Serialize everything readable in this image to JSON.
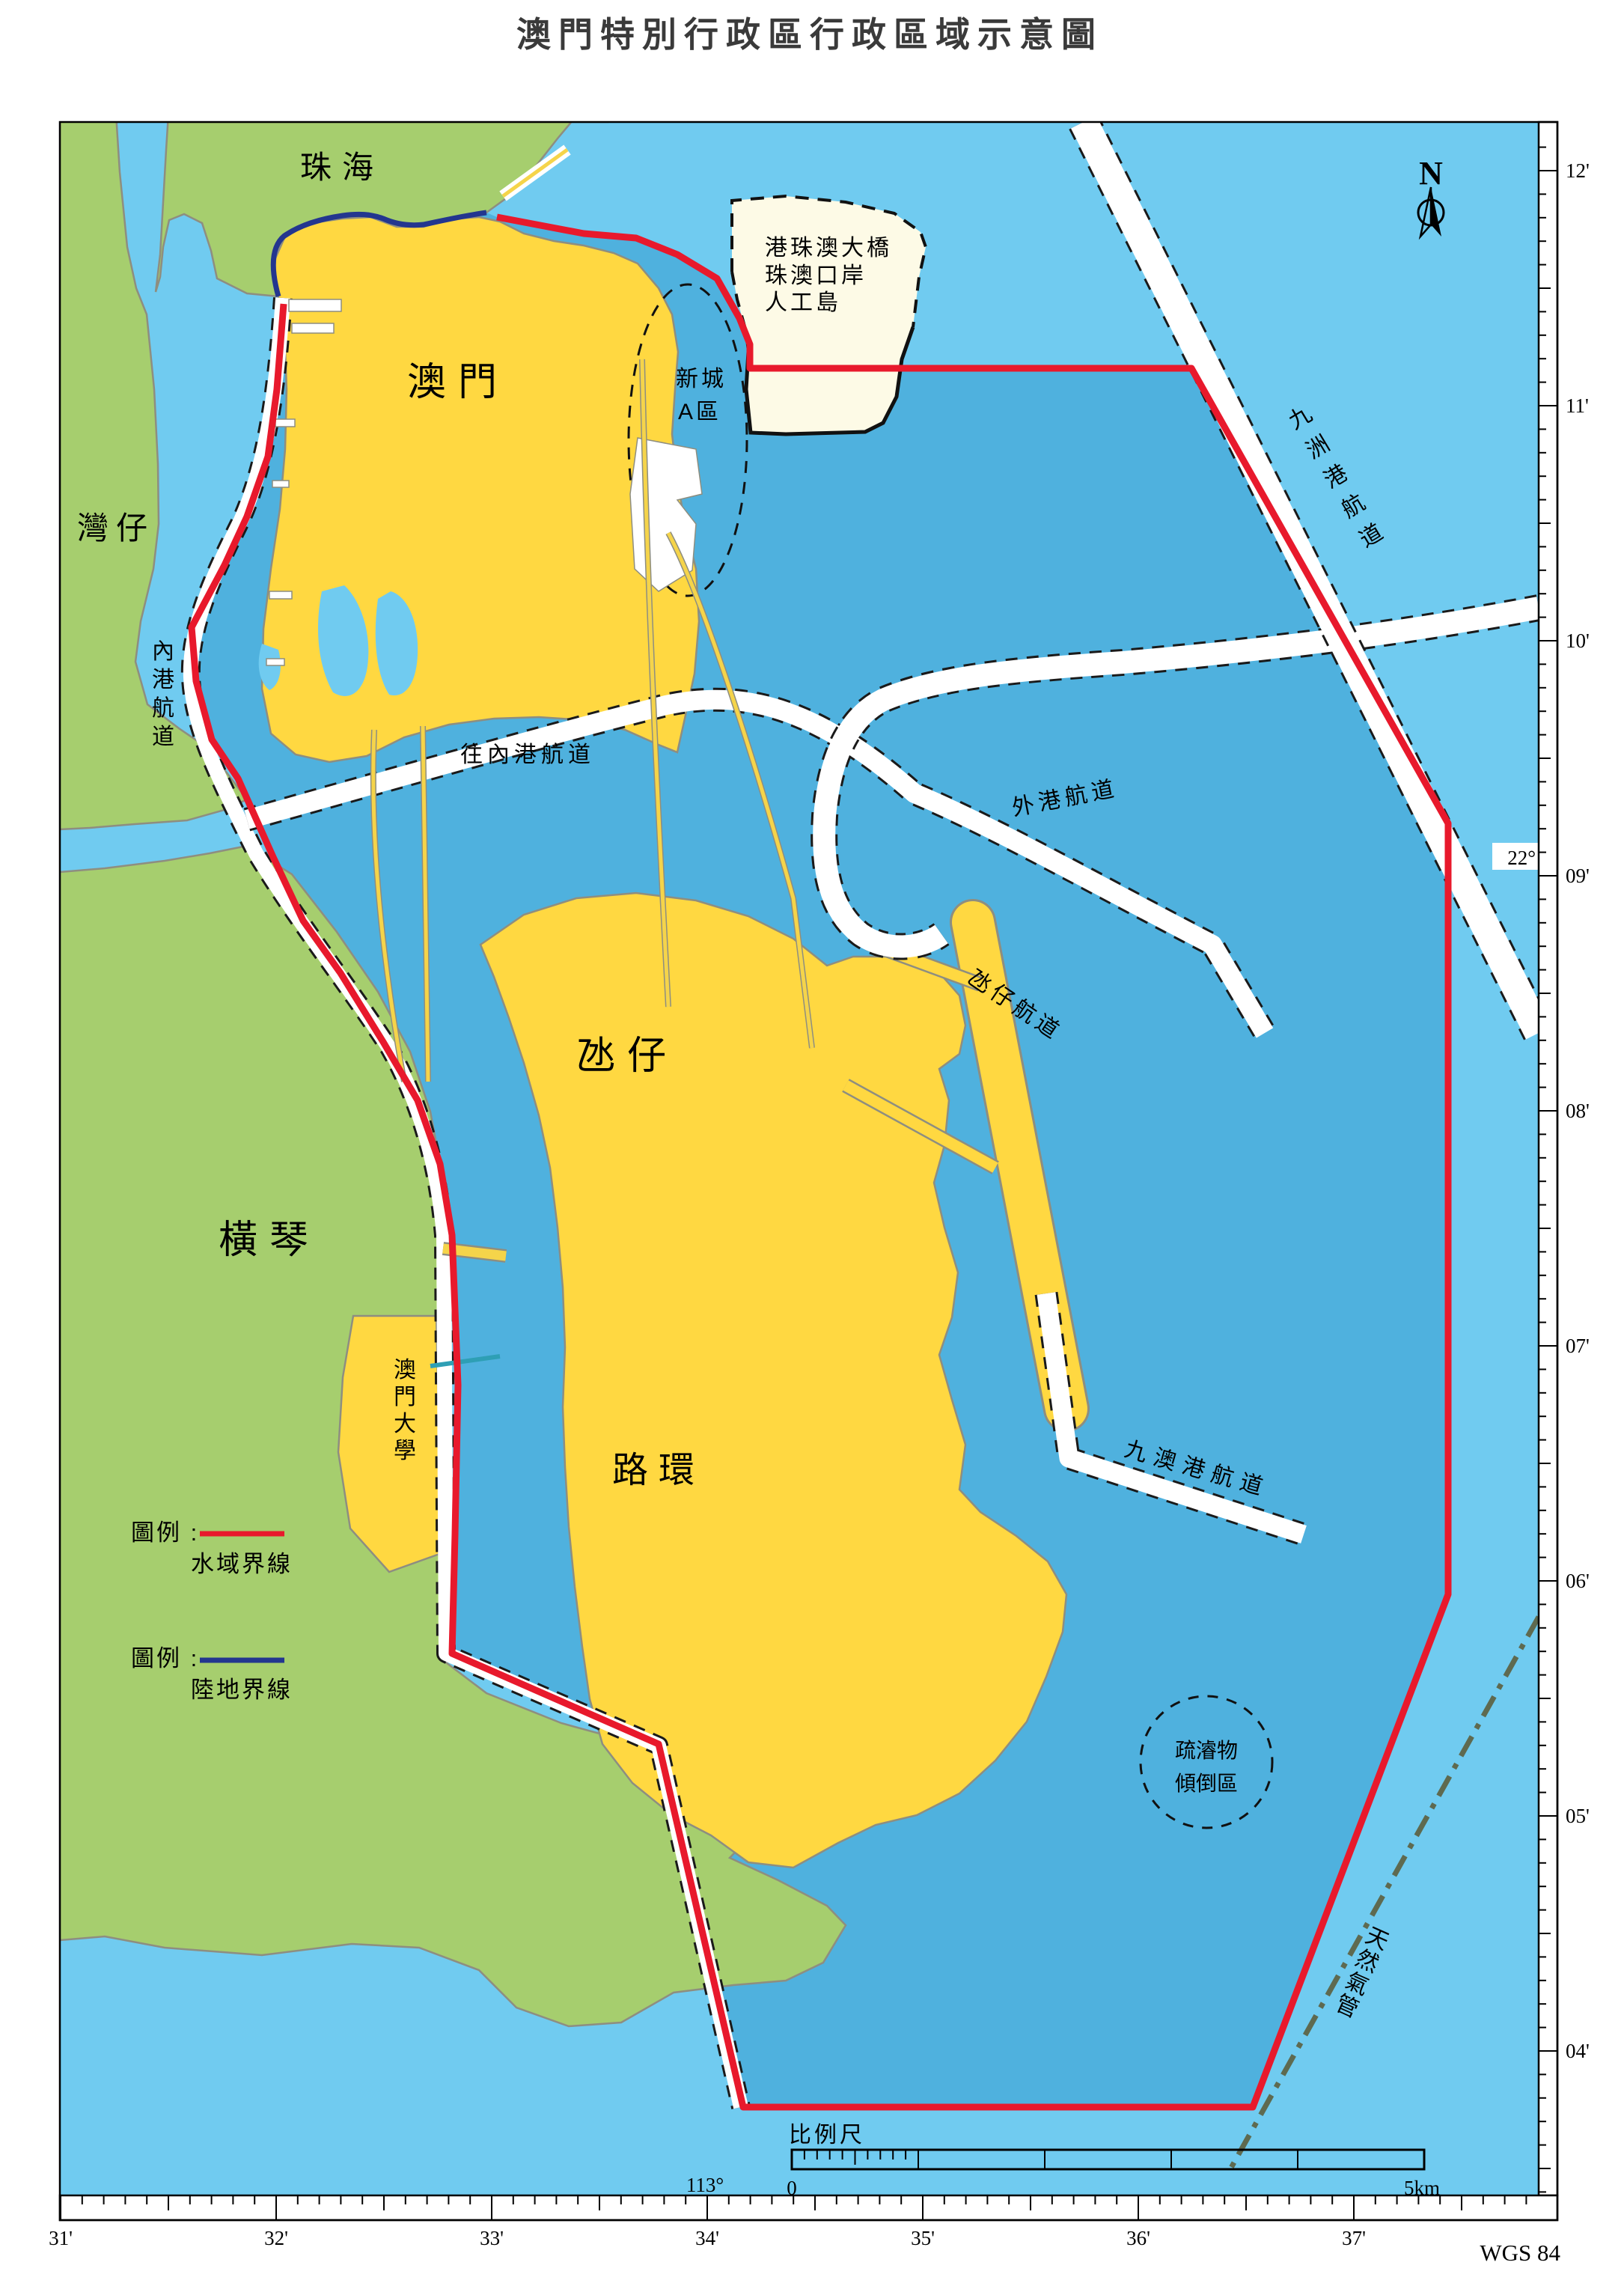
{
  "title": "澳門特別行政區行政區域示意圖",
  "datum": "WGS 84",
  "north_label": "N",
  "colors": {
    "water_outer": "#70CBF0",
    "water_inner": "#4FB1DE",
    "land_green": "#A6CE6E",
    "land_yellow": "#FFD841",
    "island_cream": "#FDFAE6",
    "boundary_water": "#E8192C",
    "boundary_land": "#23368F",
    "bridge_yellow": "#F5D44A",
    "pipeline": "#5E6A50",
    "cable_teal": "#2E9FB5"
  },
  "regions": {
    "zhuhai": "珠海",
    "wanzai": "灣仔",
    "macau": "澳門",
    "hengqin": "橫琴",
    "taipa": "氹仔",
    "coloane": "路環",
    "um": "澳門大學",
    "island_line1": "港珠澳大橋",
    "island_line2": "珠澳口岸",
    "island_line3": "人工島",
    "xincheng_line1": "新城",
    "xincheng_line2": "A區"
  },
  "channels": {
    "neigang": "內港航道",
    "wangneigang": "往內港航道",
    "waigang": "外港航道",
    "taipa_channel": "氹仔航道",
    "jiuzhougang": "九洲港航道",
    "jiuaogang": "九澳港航道"
  },
  "features": {
    "dumping_line1": "疏濬物",
    "dumping_line2": "傾倒區",
    "gas_pipe": "天然氣管"
  },
  "legend": {
    "label1": "圖例 :",
    "water_boundary": "水域界線",
    "label2": "圖例 :",
    "land_boundary": "陸地界線"
  },
  "scalebar": {
    "title": "比例尺",
    "start": "0",
    "end": "5km"
  },
  "coords": {
    "lat_deg": "22°",
    "lon_deg": "113°",
    "lat_min": [
      "12'",
      "11'",
      "10'",
      "09'",
      "08'",
      "07'",
      "06'",
      "05'",
      "04'"
    ],
    "lon_min": [
      "31'",
      "32'",
      "33'",
      "34'",
      "35'",
      "36'",
      "37'"
    ]
  }
}
